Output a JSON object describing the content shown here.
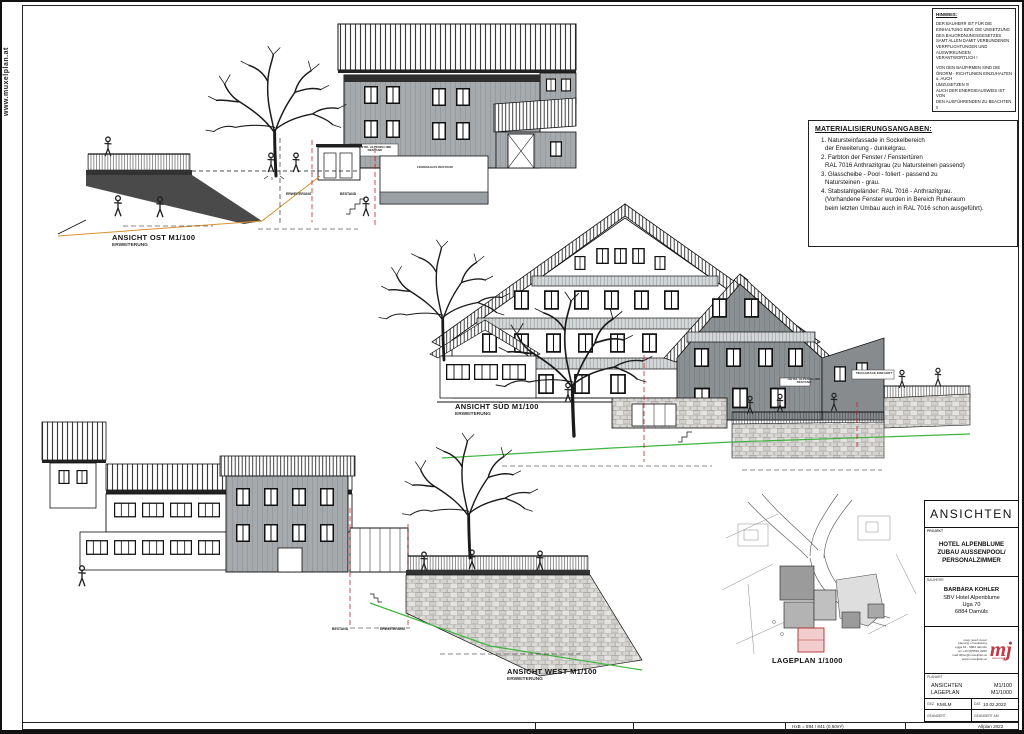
{
  "page": {
    "website_vertical": "www.muxelplan.at",
    "paper_note": "HxB = 594 / 841 (0,50m²)",
    "software_note": "Allplan 2022"
  },
  "hinweis": {
    "title": "HINWEIS:",
    "para1": "DER BAUHERR IST FÜR DIE\nEINHALTUNG BZW. DIE UMSETZUNG\nDES BAUORDNUNGSGESETZES\nSAMT ALLEN DAMIT VERBUNDENEN\nVERPFLICHTUNGEN UND AUSWIRKUNGEN\nVERANTWORTLICH !",
    "para2": "VON DEN BAUFIRMEN SIND DIE\nÖNORM - RICHTLINIEN EINZUHALTEN u. AUCH\nUMZUSETZEN !!!\nAUCH DER ENERGIEAUSWEIS IST VON\nDEN AUSFÜHRENDEN ZU BEACHTEN !!"
  },
  "materials": {
    "title": "MATERIALISIERUNGSANGABEN:",
    "items": [
      "1. Natursteinfassade in Sockelbereich\nder Erweiterung - dunkelgrau.",
      "2. Farbton der Fenster / Fenstertüren\nRAL 7016 Anthrazitgrau (zu Natursteinen passend)",
      "3. Glasscheibe - Pool - foliert - passend zu\nNatursteinen - grau.",
      "4. Stabstahlgeländer: RAL 7016 - Anthrazitgrau.\n(Vorhandene Fenster wurden in Bereich Ruheraum\nbeim letzten Umbau auch in RAL 7016 schon ausgeführt)."
    ]
  },
  "views": {
    "ost": {
      "title": "ANSICHT OST M1/100",
      "subtitle": "ERWEITERUNG"
    },
    "sued": {
      "title": "ANSICHT SÜD M1/100",
      "subtitle": "ERWEITERUNG"
    },
    "west": {
      "title": "ANSICHT WEST M1/100",
      "subtitle": "ERWEITERUNG"
    },
    "lageplan": {
      "title": "LAGEPLAN 1/1000"
    }
  },
  "annotations": {
    "erweiterung": "ERWEITERUNG",
    "bestand": "BESTAND",
    "hotel_sign": "HOTEL ALPENBLUME\nBESTAND",
    "ferienhaus_sign": "FERIENHAUS BESTAND",
    "tiefgarage_sign": "TIEFGARAGE EINFAHRT"
  },
  "titleblock": {
    "title": "ANSICHTEN",
    "project_label": "PROJEKT",
    "project": "HOTEL ALPENBLUME\nZUBAU AUSSENPOOL/\nPERSONALZIMMER",
    "client_label": "BAUHERR",
    "client_name": "BARBARA KOHLER",
    "client_address": "SBV Hotel Alpenblume\nUga 70\n6884 Damüls",
    "office_lines": "mag. josef muxel\nplanung + bauleitung\negga 81 · 6884 damüls\ntel +43 (0)5510 2260\nmail office@muxelplan.at\nwww.muxelplan.at",
    "logo_text": "mj",
    "logo_sub": "muxelplan",
    "plan_label": "PLANART",
    "plan_type": "ANSICHTEN\nLAGEPLAN",
    "plan_scale": "M1/100\nM1/1000",
    "drawn_label": "GEZ.",
    "drawn_value": "KM/LM",
    "date_label": "DAT.",
    "date_value": "10.02.2022",
    "changed_label": "GEÄNDERT",
    "changed_label2": "GEÄNDERT AM"
  },
  "colors": {
    "logo_red": "#c13a45",
    "new_building_pink": "#f3cdcd",
    "terrain_green": "#3db53d",
    "marker_red": "#cc2222",
    "facade_gray": "#a6aaac"
  }
}
